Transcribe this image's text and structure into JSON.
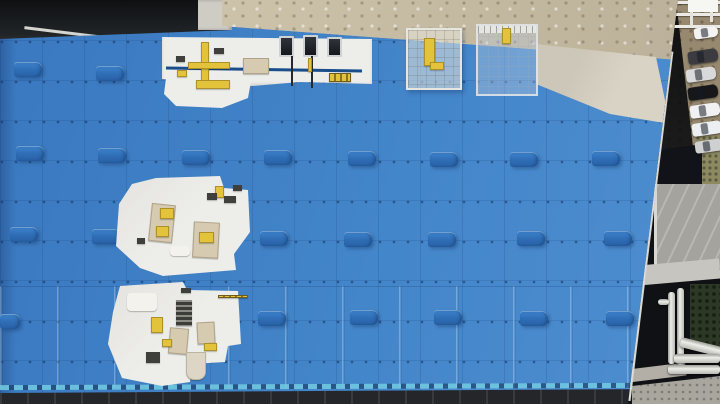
{
  "colors": {
    "roof-blue": "#3F7FC5",
    "vent-blue": "#2E6CB4",
    "edge-aqua": "#72CBE0",
    "facade-dark": "#24262A",
    "concrete-tan": "#C8BEA7",
    "pale-concrete": "#D9D3C6",
    "white-roof": "#EDEDEA",
    "pipe-blue": "#1A4E8A",
    "equip-yellow": "#E3C33C",
    "dirt": "#97896F",
    "slab-gray": "#A4A39D",
    "vegetation": "#2E3826",
    "paving": "#A9A69E"
  },
  "roof": {
    "vents": [
      [
        14,
        62
      ],
      [
        96,
        66
      ],
      [
        16,
        146
      ],
      [
        98,
        148
      ],
      [
        182,
        150
      ],
      [
        264,
        150
      ],
      [
        348,
        151
      ],
      [
        430,
        152
      ],
      [
        510,
        152
      ],
      [
        592,
        151
      ],
      [
        10,
        227
      ],
      [
        92,
        229
      ],
      [
        260,
        231
      ],
      [
        344,
        232
      ],
      [
        428,
        232
      ],
      [
        517,
        231
      ],
      [
        604,
        231
      ],
      [
        0,
        314,
        20
      ],
      [
        258,
        311
      ],
      [
        350,
        310
      ],
      [
        434,
        310
      ],
      [
        520,
        311
      ],
      [
        606,
        311
      ]
    ]
  },
  "top_strip": {
    "hvac_units": [
      {
        "x": 279,
        "y": 36,
        "w": 15,
        "h": 21
      },
      {
        "x": 303,
        "y": 35,
        "w": 15,
        "h": 22
      },
      {
        "x": 327,
        "y": 37,
        "w": 15,
        "h": 20
      }
    ],
    "conduits": [
      {
        "x": 291,
        "y": 56,
        "w": 2,
        "h": 30
      },
      {
        "x": 311,
        "y": 56,
        "w": 2,
        "h": 32
      }
    ],
    "yellow_pole": {
      "x": 308,
      "y": 58,
      "w": 4,
      "h": 14
    },
    "yellow_pallet": {
      "x": 329,
      "y": 73,
      "w": 22,
      "h": 9
    }
  },
  "equipment": [
    {
      "t": "yellow",
      "x": 201,
      "y": 42,
      "w": 8,
      "h": 44
    },
    {
      "t": "yellow",
      "x": 188,
      "y": 62,
      "w": 42,
      "h": 7
    },
    {
      "t": "yellow",
      "x": 196,
      "y": 80,
      "w": 34,
      "h": 9
    },
    {
      "t": "dark",
      "x": 214,
      "y": 48,
      "w": 10,
      "h": 6
    },
    {
      "t": "panel",
      "x": 243,
      "y": 58,
      "w": 26,
      "h": 16
    },
    {
      "t": "dark",
      "x": 176,
      "y": 56,
      "w": 9,
      "h": 6
    },
    {
      "t": "yellow",
      "x": 177,
      "y": 70,
      "w": 10,
      "h": 7
    },
    {
      "t": "panel",
      "x": 150,
      "y": 204,
      "w": 24,
      "h": 38,
      "r": 6
    },
    {
      "t": "panel",
      "x": 193,
      "y": 222,
      "w": 26,
      "h": 36,
      "r": 3
    },
    {
      "t": "yellow",
      "x": 160,
      "y": 208,
      "w": 14,
      "h": 11
    },
    {
      "t": "yellow",
      "x": 156,
      "y": 226,
      "w": 13,
      "h": 11
    },
    {
      "t": "yellow",
      "x": 199,
      "y": 232,
      "w": 15,
      "h": 11
    },
    {
      "t": "yellow",
      "x": 215,
      "y": 186,
      "w": 9,
      "h": 12
    },
    {
      "t": "dark",
      "x": 207,
      "y": 193,
      "w": 10,
      "h": 7
    },
    {
      "t": "dark",
      "x": 224,
      "y": 196,
      "w": 12,
      "h": 7
    },
    {
      "t": "dark",
      "x": 233,
      "y": 185,
      "w": 9,
      "h": 6
    },
    {
      "t": "dark",
      "x": 137,
      "y": 238,
      "w": 8,
      "h": 6
    },
    {
      "t": "white",
      "x": 170,
      "y": 246,
      "w": 20,
      "h": 10
    },
    {
      "t": "white",
      "x": 127,
      "y": 293,
      "w": 30,
      "h": 18
    },
    {
      "t": "stack",
      "x": 176,
      "y": 300,
      "w": 16,
      "h": 26
    },
    {
      "t": "panel",
      "x": 169,
      "y": 328,
      "w": 19,
      "h": 26,
      "r": 5
    },
    {
      "t": "panel",
      "x": 197,
      "y": 322,
      "w": 18,
      "h": 22,
      "r": -3
    },
    {
      "t": "yellow",
      "x": 151,
      "y": 317,
      "w": 12,
      "h": 16
    },
    {
      "t": "yellow",
      "x": 162,
      "y": 339,
      "w": 10,
      "h": 8
    },
    {
      "t": "yellow",
      "x": 204,
      "y": 343,
      "w": 13,
      "h": 8
    },
    {
      "t": "dark",
      "x": 146,
      "y": 352,
      "w": 14,
      "h": 11
    },
    {
      "t": "stripe",
      "x": 218,
      "y": 295,
      "w": 30,
      "h": 3
    },
    {
      "t": "dark",
      "x": 181,
      "y": 288,
      "w": 10,
      "h": 5
    },
    {
      "t": "tail",
      "x": 186,
      "y": 352,
      "w": 20,
      "h": 28
    },
    {
      "t": "yellow",
      "x": 424,
      "y": 38,
      "w": 11,
      "h": 28
    },
    {
      "t": "yellow",
      "x": 430,
      "y": 62,
      "w": 14,
      "h": 8
    },
    {
      "t": "yellow",
      "x": 502,
      "y": 28,
      "w": 9,
      "h": 16
    }
  ],
  "right_side": {
    "scaffold_bars": [
      {
        "x": 30,
        "y": 1,
        "w": 74
      },
      {
        "x": 34,
        "y": 13,
        "w": 70
      },
      {
        "x": 40,
        "y": 25,
        "w": 64
      }
    ],
    "scaffold_posts": [
      {
        "x": 50,
        "h": 30
      },
      {
        "x": 74,
        "h": 26
      },
      {
        "x": 94,
        "h": 22
      }
    ],
    "cars": [
      {
        "color": "#F3F3F1",
        "x": 78,
        "y": 27,
        "w": 24,
        "h": 11
      },
      {
        "color": "#3C3C40",
        "x": 72,
        "y": 50,
        "w": 30,
        "h": 13
      },
      {
        "color": "#D9D9DB",
        "x": 70,
        "y": 68,
        "w": 30,
        "h": 13
      },
      {
        "color": "#17171A",
        "x": 72,
        "y": 86,
        "w": 30,
        "h": 13
      },
      {
        "color": "#F1F1F3",
        "x": 74,
        "y": 104,
        "w": 30,
        "h": 13
      },
      {
        "color": "#ECEFF1",
        "x": 76,
        "y": 122,
        "w": 30,
        "h": 13
      },
      {
        "color": "#CFD0D2",
        "x": 79,
        "y": 140,
        "w": 28,
        "h": 12
      }
    ],
    "pipes": [
      {
        "dir": "v",
        "x": 52,
        "y": 292,
        "w": 7,
        "h": 72
      },
      {
        "dir": "v",
        "x": 61,
        "y": 288,
        "w": 7,
        "h": 78
      },
      {
        "dir": "d",
        "x": 64,
        "y": 342,
        "w": 42,
        "h": 10,
        "r": 14
      },
      {
        "dir": "h",
        "x": 58,
        "y": 354,
        "w": 46,
        "h": 9
      },
      {
        "dir": "h",
        "x": 52,
        "y": 365,
        "w": 52,
        "h": 9
      },
      {
        "dir": "h",
        "x": 42,
        "y": 299,
        "w": 11,
        "h": 6
      }
    ]
  }
}
